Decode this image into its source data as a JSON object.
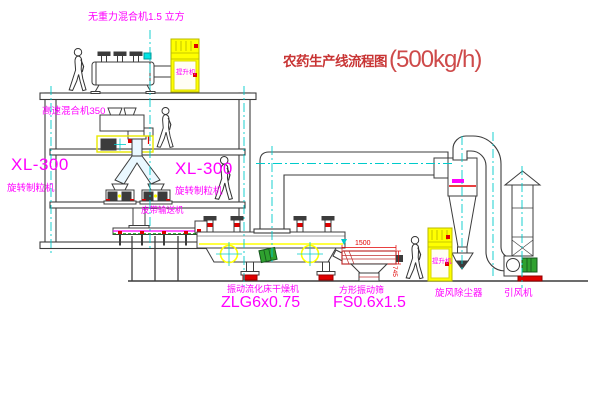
{
  "diagram": {
    "title": "农药生产线流程图",
    "capacity": "(500kg/h)",
    "labels": {
      "gravity_mixer": "无重力混合机1.5 立方",
      "high_speed_mixer": "高速混合机350",
      "granulator_1": {
        "model": "XL-300",
        "name": "旋转制粒机"
      },
      "granulator_2": {
        "model": "XL-300",
        "name": "旋转制粒机"
      },
      "belt_conveyor": "皮带输送机",
      "fluid_bed_dryer": {
        "name": "振动流化床干燥机",
        "model": "ZLG6x0.75"
      },
      "vibrating_screen": {
        "name": "方形振动筛",
        "model": "FS0.6x1.5"
      },
      "cyclone": "旋风除尘器",
      "draft_fan": "引风机",
      "hoist_1": "提升机",
      "hoist_2": "提升机"
    },
    "dimension_annotations": {
      "screen_length": "1500",
      "screen_height": "745"
    },
    "colors": {
      "label_magenta": "#FF00FF",
      "title_red": "#C83434",
      "accent_red": "#E00000",
      "equipment_yellow": "#FFFF00",
      "centerline_cyan": "#00CBCB",
      "line_dark": "#3C3C3C",
      "motor_green": "#2FA12F"
    }
  }
}
